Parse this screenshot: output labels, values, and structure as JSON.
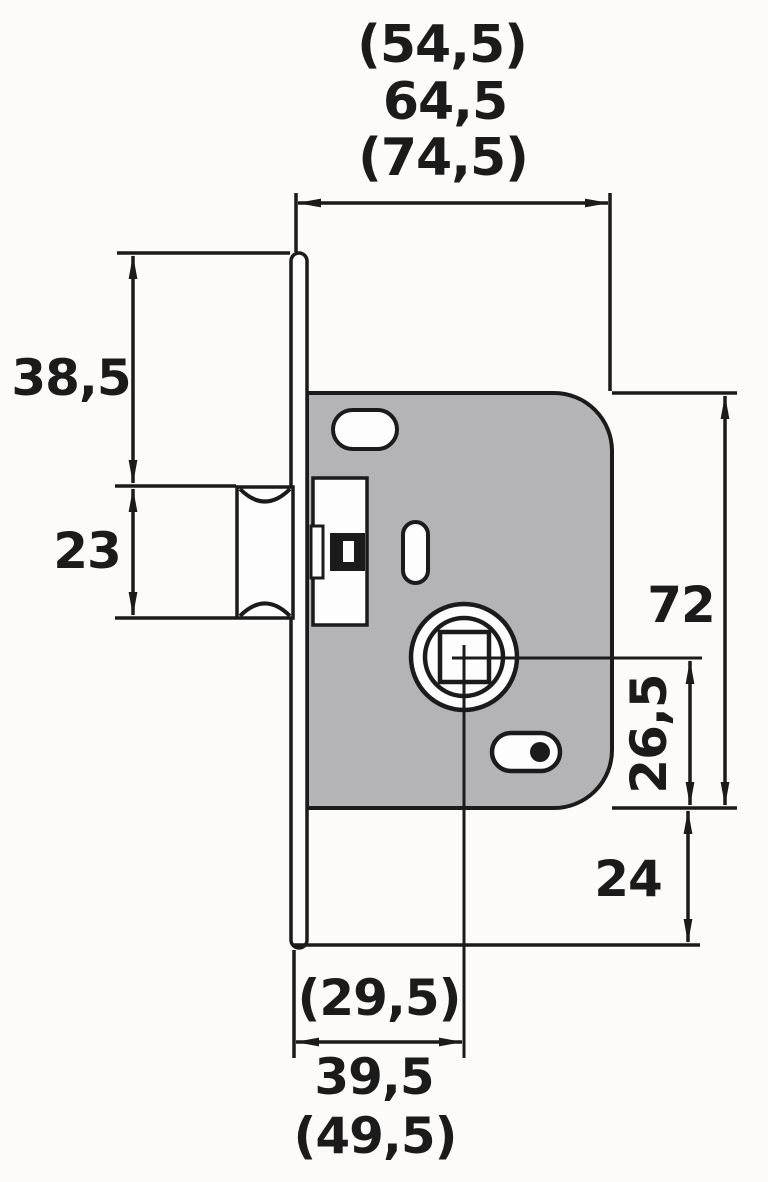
{
  "drawing": {
    "type": "mortise-lock-dimension-drawing",
    "units_note": "comma-decimal millimetre values, parenthesised = optional variants",
    "dims": {
      "top_width_variant_small": "(54,5)",
      "top_width_main": "64,5",
      "top_width_variant_large": "(74,5)",
      "left_upper_height": "38,5",
      "left_bolt_height": "23",
      "right_body_height": "72",
      "right_spindle_offset": "26,5",
      "right_below_body": "24",
      "bottom_backset_variant_small": "(29,5)",
      "bottom_backset_main": "39,5",
      "bottom_backset_variant_large": "(49,5)"
    },
    "colors": {
      "bg": "#fcfbf9",
      "line": "#1b1b1b",
      "body_fill": "#b4b4b6",
      "hole_fill": "#fdfdfd"
    }
  }
}
